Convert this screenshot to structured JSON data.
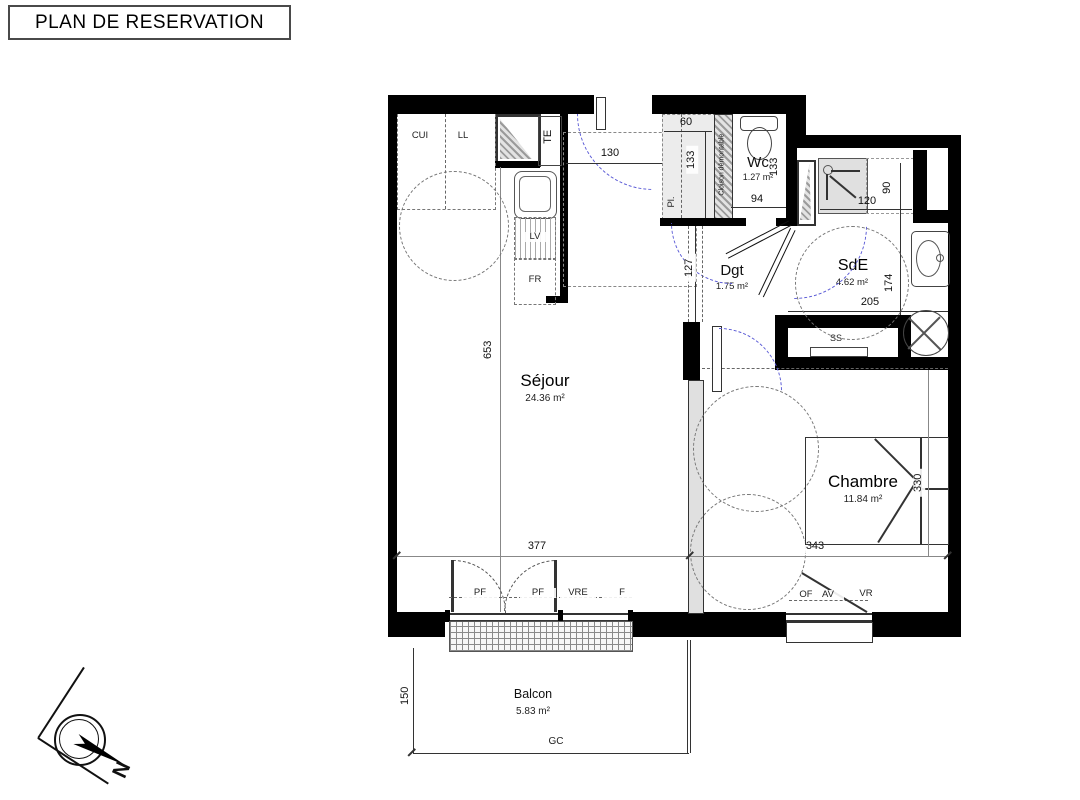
{
  "title": "PLAN DE RESERVATION",
  "rooms": {
    "sejour": {
      "name": "Séjour",
      "area": "24.36 m²"
    },
    "chambre": {
      "name": "Chambre",
      "area": "11.84 m²"
    },
    "wc": {
      "name": "Wc",
      "area": "1.27 m²"
    },
    "sde": {
      "name": "SdE",
      "area": "4.62 m²"
    },
    "dgt": {
      "name": "Dgt",
      "area": "1.75 m²"
    },
    "balcon": {
      "name": "Balcon",
      "area": "5.83 m²"
    }
  },
  "dims": {
    "entrance": "130",
    "closet_w": "60",
    "closet_d": "133",
    "wc_d": "133",
    "wc_w": "94",
    "shower_w": "120",
    "shower_d": "90",
    "sde_d": "174",
    "sde_w": "205",
    "passage": "127",
    "sejour_l": "653",
    "sejour_w": "377",
    "chambre_w": "343",
    "chambre_d": "330",
    "balcon_d": "150"
  },
  "fixtures": {
    "kitchen_unit": "CUI",
    "washer": "LL",
    "elec_panel": "TE",
    "dishwasher": "LV",
    "fridge": "FR",
    "closet": "Pl.",
    "partition": "Cloison démontable",
    "towel_rail": "SS"
  },
  "openings": {
    "pf": "PF",
    "vre": "VRE",
    "f": "F",
    "of": "OF",
    "av": "AV",
    "vr": "VR",
    "railing": "GC"
  },
  "compass": {
    "north": "N"
  },
  "colors": {
    "wall": "#000000",
    "swing_arc": "#5c5cd6",
    "partition_fill": "#e0e0e0"
  }
}
